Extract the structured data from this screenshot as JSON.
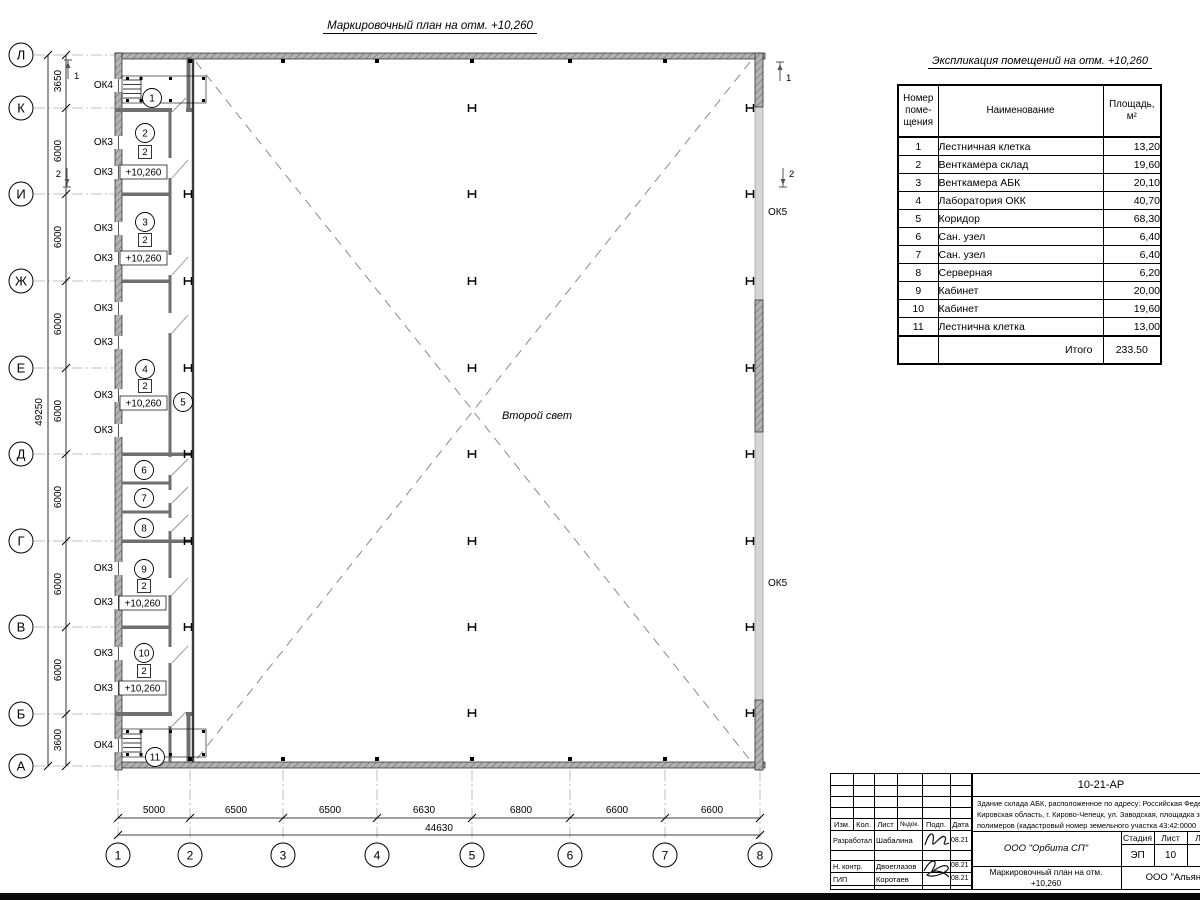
{
  "plan_title": "Маркировочный план на отм. +10,260",
  "plan": {
    "second_light": "Второй свет",
    "elevation": "+10,260",
    "category_mark": "2",
    "marks": {
      "ok3": "ОК3",
      "ok4": "ОК4",
      "ok5": "ОК5"
    },
    "rooms": [
      "1",
      "2",
      "3",
      "4",
      "5",
      "6",
      "7",
      "8",
      "9",
      "10",
      "11"
    ],
    "sections": [
      "1",
      "2"
    ]
  },
  "axes": {
    "rows": [
      "Л",
      "К",
      "И",
      "Ж",
      "Е",
      "Д",
      "Г",
      "В",
      "Б",
      "А"
    ],
    "cols": [
      "1",
      "2",
      "3",
      "4",
      "5",
      "6",
      "7",
      "8"
    ],
    "row_dims": [
      "3650",
      "6000",
      "6000",
      "6000",
      "6000",
      "6000",
      "6000",
      "6000",
      "3600"
    ],
    "row_total": "49250",
    "col_dims": [
      "5000",
      "6500",
      "6500",
      "6630",
      "6800",
      "6600",
      "6600"
    ],
    "col_total": "44630"
  },
  "table": {
    "title": "Экспликация помещений на отм. +10,260",
    "col_num": "Номер\nпоме-\nщения",
    "col_name": "Наименование",
    "col_area": "Площадь,\nм²",
    "rows": [
      {
        "num": "1",
        "name": "Лестничная клетка",
        "area": "13,20"
      },
      {
        "num": "2",
        "name": "Венткамера склад",
        "area": "19,60"
      },
      {
        "num": "3",
        "name": "Венткамера АБК",
        "area": "20,10"
      },
      {
        "num": "4",
        "name": "Лаборатория ОКК",
        "area": "40,70"
      },
      {
        "num": "5",
        "name": "Коридор",
        "area": "68,30"
      },
      {
        "num": "6",
        "name": "Сан. узел",
        "area": "6,40"
      },
      {
        "num": "7",
        "name": "Сан. узел",
        "area": "6,40"
      },
      {
        "num": "8",
        "name": "Серверная",
        "area": "6,20"
      },
      {
        "num": "9",
        "name": "Кабинет",
        "area": "20,00"
      },
      {
        "num": "10",
        "name": "Кабинет",
        "area": "19,60"
      },
      {
        "num": "11",
        "name": "Лестнична клетка",
        "area": "13,00"
      }
    ],
    "total_label": "Итого",
    "total_value": "233.50"
  },
  "title_block": {
    "doc_code": "10-21-АР",
    "description": [
      "Здание склада АБК, расположенное по адресу: Российская Феде",
      "Кировская область, г. Кирово-Чепецк, ул. Заводская, площадка з",
      "полимеров (кадастровый номер земельного участка 43:42:0000"
    ],
    "header_cols": [
      "Изм.",
      "Кол.",
      "Лист",
      "№док.",
      "Подп.",
      "Дата"
    ],
    "roles": [
      {
        "role": "Разработал",
        "name": "Шабалина",
        "date": "08.21"
      },
      {
        "role": "Н. контр.",
        "name": "Двоеглазов",
        "date": "08.21"
      },
      {
        "role": "ГИП",
        "name": "Коротаев",
        "date": "08.21"
      }
    ],
    "company": "ООО \"Орбита СП\"",
    "stage_label": "Стадия",
    "sheet_label": "Лист",
    "sheets_label": "Листов",
    "stage": "ЭП",
    "sheet": "10",
    "sheets": "1",
    "doc_name_line1": "Маркировочный план на отм.",
    "doc_name_line2": "+10,260",
    "company2": "ООО \"Альяно"
  }
}
